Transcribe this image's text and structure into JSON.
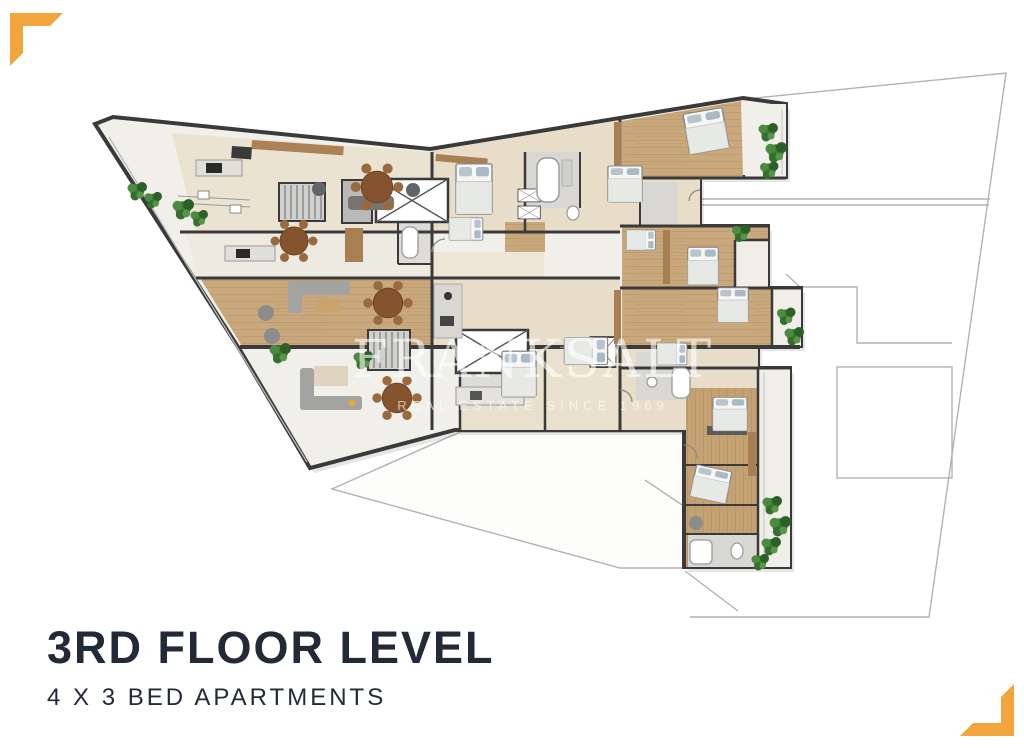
{
  "document": {
    "kind": "real-estate floor plan flyer",
    "background": "#ffffff"
  },
  "title_block": {
    "title": "3RD FLOOR LEVEL",
    "subtitle": "4 X 3 BED APARTMENTS",
    "text_color": "#222A38"
  },
  "watermark": {
    "line1": "FRANKSALT",
    "line2": "REAL ESTATE SINCE 1969",
    "color": "#ffffff"
  },
  "brand": {
    "accent_color": "#F2A53C"
  },
  "floor_plan": {
    "label": "3rd floor level plan, 4 three-bedroom apartments",
    "apartment_count": 4,
    "bedrooms_per_apartment": 3,
    "palette": {
      "walls": "#3A3A3A",
      "wood_floor": "#C8A87C",
      "stone_floor": "#F1EFE9",
      "interior_floor": "#E9E1CD",
      "bathroom_tile": "#D8D7D3",
      "plants": "#3E7C36",
      "boundary_line": "#B3B2AE"
    }
  }
}
